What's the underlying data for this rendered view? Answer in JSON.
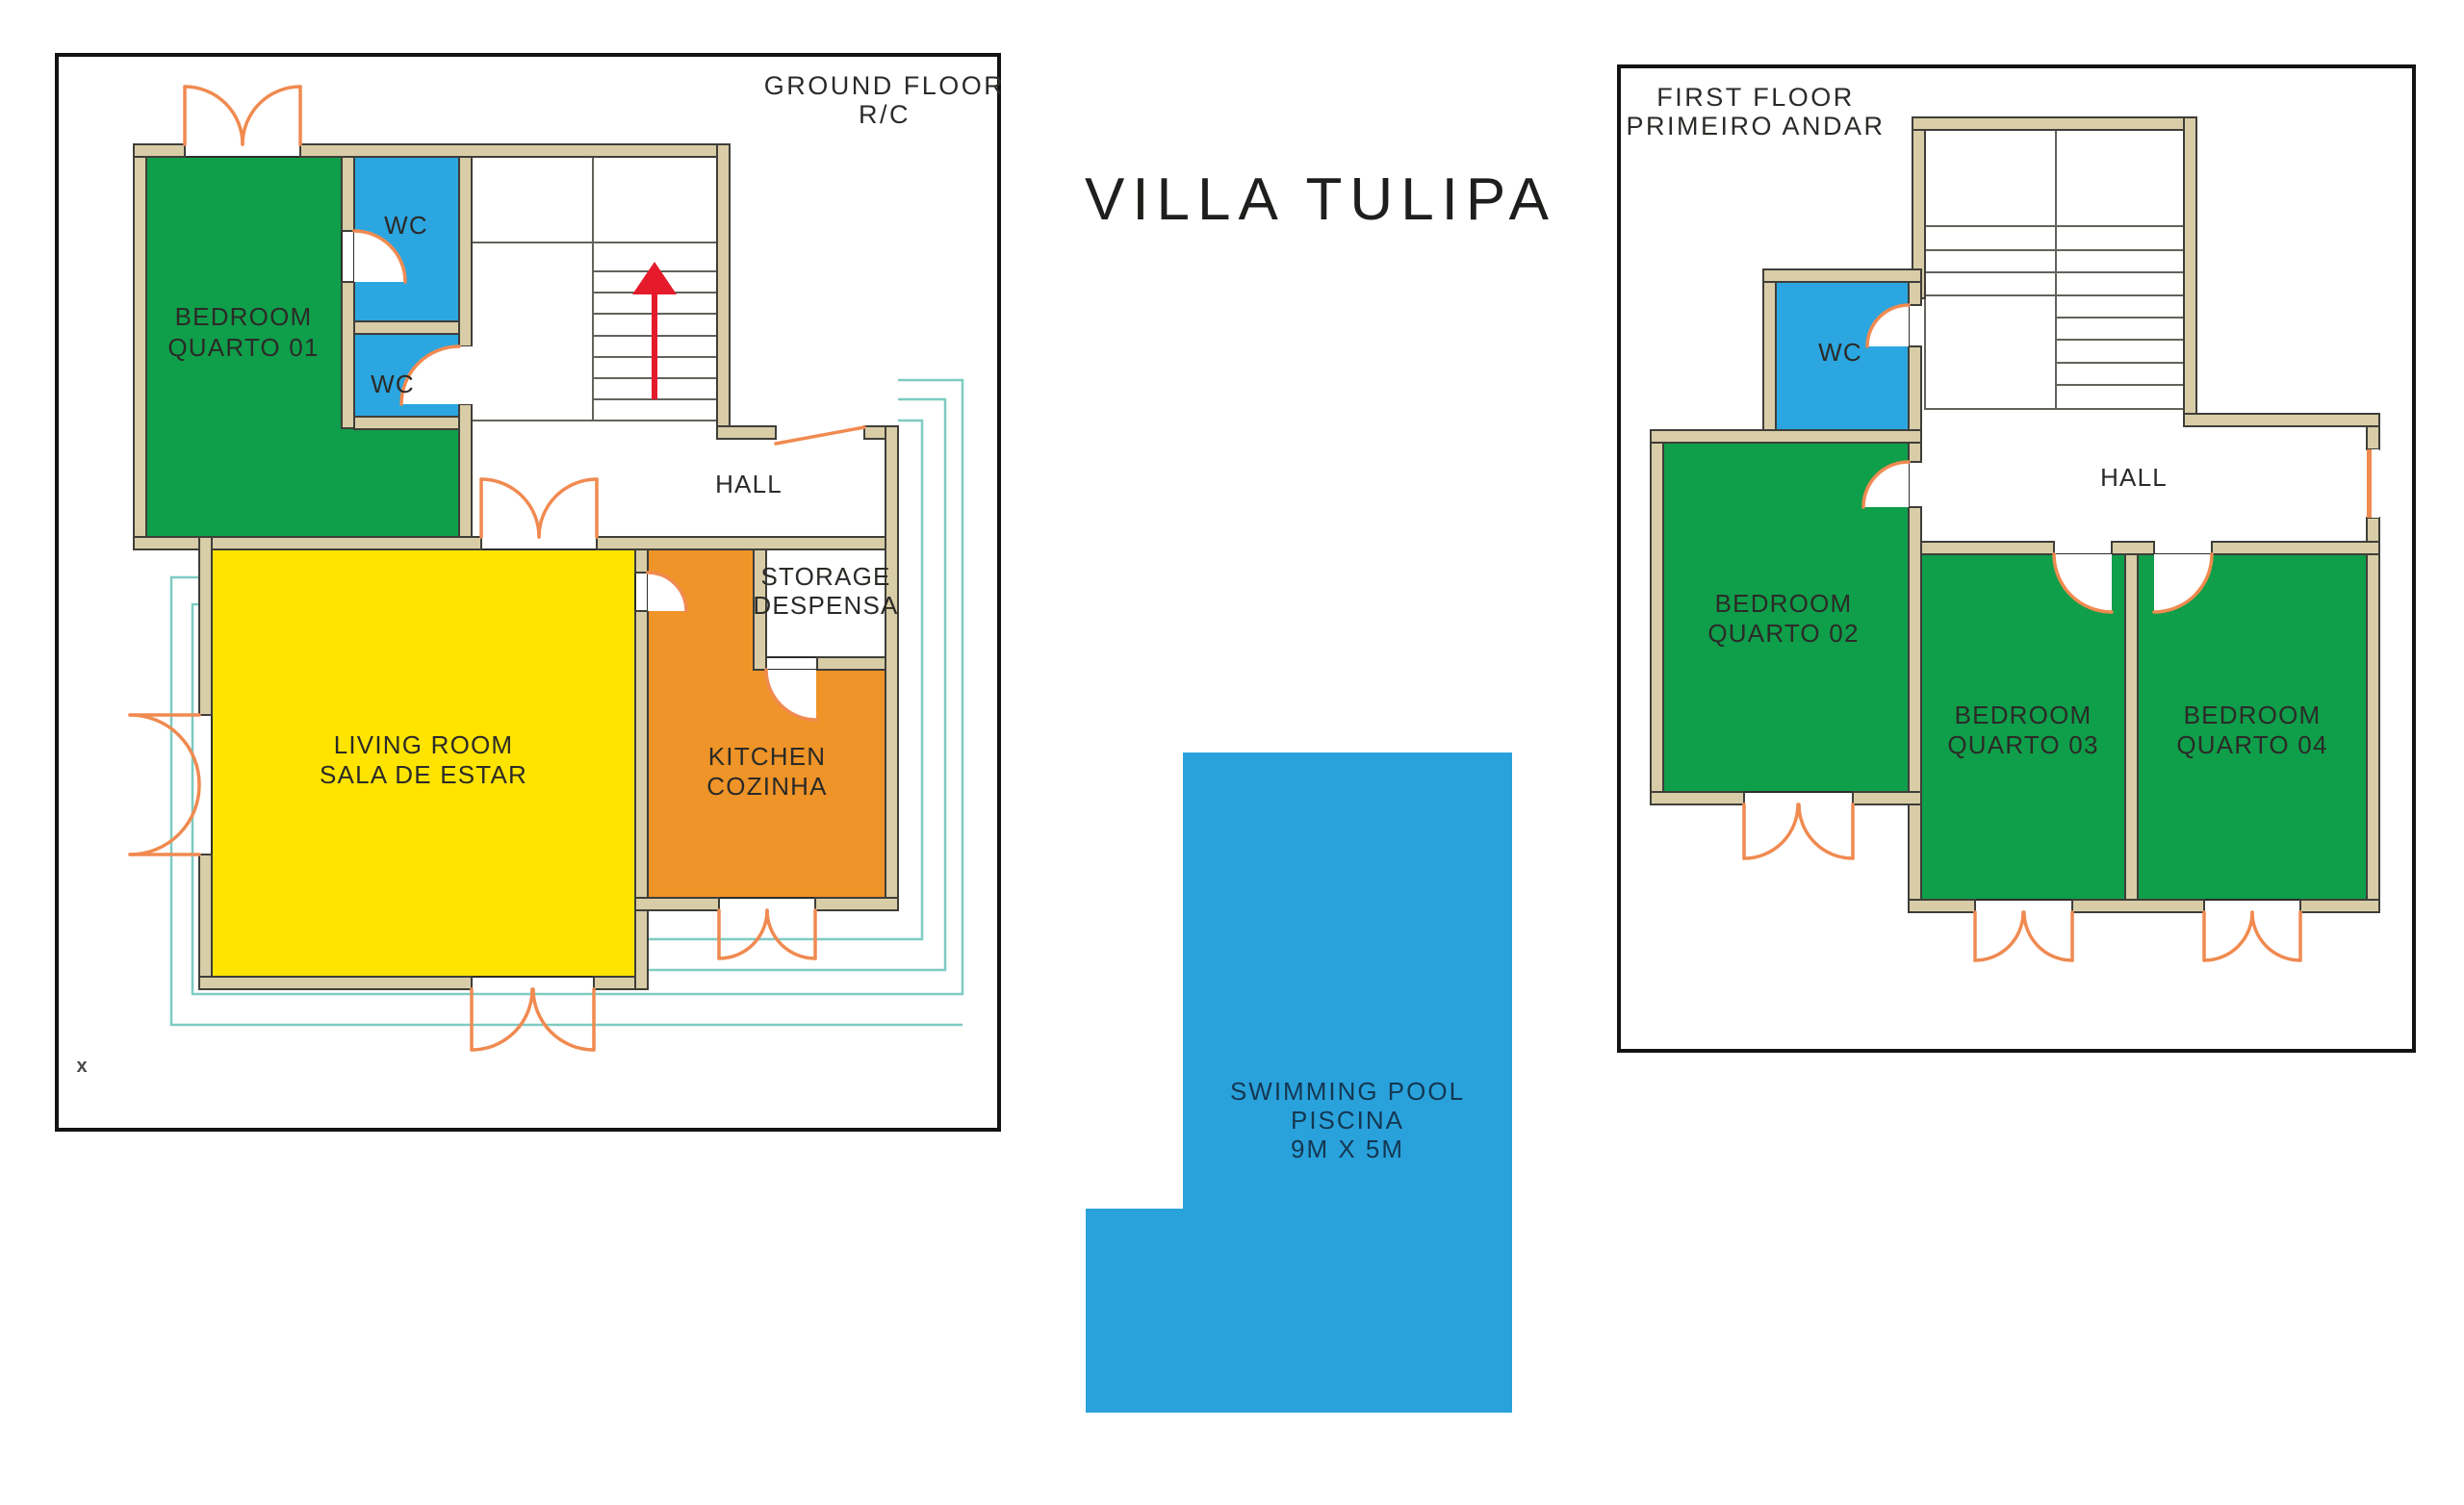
{
  "title": "VILLA TULIPA",
  "ground_floor": {
    "heading_line1": "GROUND FLOOR",
    "heading_line2": "R/C",
    "rooms": {
      "bedroom01_line1": "BEDROOM",
      "bedroom01_line2": "QUARTO 01",
      "wc_upper": "WC",
      "wc_lower": "WC",
      "hall": "HALL",
      "storage_line1": "STORAGE",
      "storage_line2": "DESPENSA",
      "kitchen_line1": "KITCHEN",
      "kitchen_line2": "COZINHA",
      "living_line1": "LIVING ROOM",
      "living_line2": "SALA DE ESTAR"
    },
    "marker": "x"
  },
  "first_floor": {
    "heading_line1": "FIRST FLOOR",
    "heading_line2": "PRIMEIRO ANDAR",
    "rooms": {
      "wc": "WC",
      "hall": "HALL",
      "bedroom02_line1": "BEDROOM",
      "bedroom02_line2": "QUARTO 02",
      "bedroom03_line1": "BEDROOM",
      "bedroom03_line2": "QUARTO 03",
      "bedroom04_line1": "BEDROOM",
      "bedroom04_line2": "QUARTO 04"
    }
  },
  "pool": {
    "line1": "SWIMMING POOL",
    "line2": "PISCINA",
    "line3": "9M X 5M"
  },
  "colors": {
    "bedroom_green": "#0f9e4a",
    "wc_blue": "#2ba6e0",
    "living_yellow": "#ffe400",
    "kitchen_orange": "#ef9428",
    "pool_blue": "#29a2dc",
    "wall_tan": "#d8cda7",
    "door_orange": "#f08a50",
    "terrace_teal": "#7ecbc2",
    "stairs_arrow_red": "#e51a2b"
  }
}
